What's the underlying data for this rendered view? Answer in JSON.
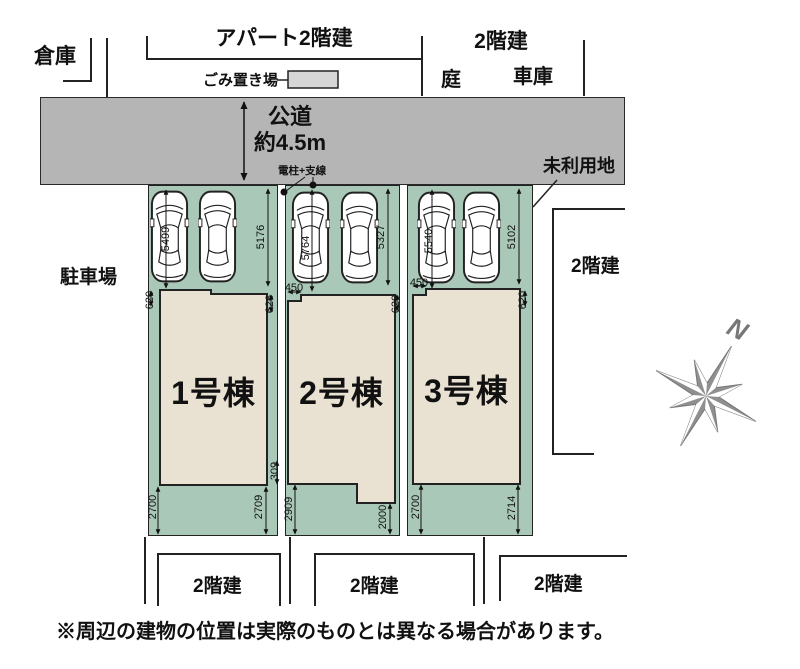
{
  "plan": {
    "disclaimer": "※周辺の建物の位置は実際のものとは異なる場合があります。",
    "compass_label": "N"
  },
  "surroundings": {
    "warehouse": "倉庫",
    "apartment": "アパート2階建",
    "trash_area": "ごみ置き場",
    "north_building": "2階建",
    "garden": "庭",
    "garage": "車庫",
    "unused_land": "未利用地",
    "parking_lot": "駐車場",
    "east_building": "2階建",
    "south_buildings": [
      "2階建",
      "2階建",
      "2階建"
    ]
  },
  "road": {
    "name": "公道",
    "width": "約4.5m"
  },
  "pole_label": "電柱+支線",
  "lots": [
    {
      "name": "1号棟",
      "dims": {
        "parking_depth": "5499",
        "side_depth": "5176",
        "top_left": "620",
        "top_right": "626",
        "mid_right": "309",
        "bottom_left": "2700",
        "bottom_right": "2709"
      }
    },
    {
      "name": "2号棟",
      "dims": {
        "parking_depth": "5764",
        "side_depth": "5327",
        "top_offset": "450",
        "top_right": "620",
        "bottom_left": "2909",
        "bottom_right": "2000"
      }
    },
    {
      "name": "3号棟",
      "dims": {
        "parking_depth": "5540",
        "side_depth": "5102",
        "top_offset": "450",
        "top_right": "620",
        "bottom_left": "2700",
        "bottom_right": "2714"
      }
    }
  ],
  "colors": {
    "road": "#b5b5b5",
    "lot_green": "#a9c8b7",
    "building_beige": "#e9e2d2",
    "compass_gray": "#8f8f8f",
    "trash_gray": "#d6d6d6"
  }
}
